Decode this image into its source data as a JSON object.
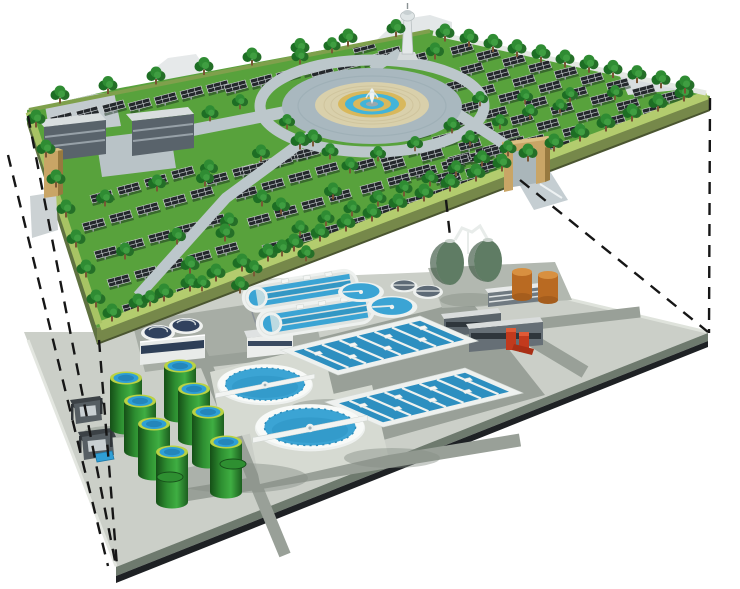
{
  "diagram": {
    "kind": "3d-cutaway-illustration",
    "upper_layer_name": "ground-level-solar-park",
    "lower_layer_name": "underground-wastewater-treatment-plant",
    "background": "#ffffff"
  },
  "palette": {
    "grass": "#58a23c",
    "grass_border": "#b3cc6e",
    "park_side_front": "#76884a",
    "park_side_left": "#5f7240",
    "park_back_path": "#e4e8e3",
    "plaza": "#a9b8bf",
    "cobble": "#d9d0ab",
    "fountain_tan": "#d8b85c",
    "fountain_blue": "#42b4d9",
    "road": "#bcc7cb",
    "building": "#59636b",
    "gate_tan": "#c9a566",
    "gate_tan_dark": "#97793f",
    "tree_dark": "#1d6e24",
    "tree_light": "#2f8c33",
    "trunk": "#7a5433",
    "panel": "#24282c",
    "panel_frame": "#d8dcde",
    "pavement": "#cbcfc8",
    "pavement_dark": "#99a098",
    "pavement_pad": "#d6dad2",
    "plant_edge_mid": "#6e7a6e",
    "plant_edge_dark": "#1e2124",
    "tank_green": "#2e8f31",
    "tank_rim": "#b9d244",
    "tank_water": "#2e9fd6",
    "clarifier_water": "#3ba4d4",
    "basin_water": "#2d8fc0",
    "unit_white": "#eef1ef",
    "digester_green": "#5f7c64",
    "orange_tank": "#b96a22",
    "orange_top": "#d89040",
    "red_equipment": "#c23a1d",
    "navy_cover": "#31425e",
    "slate_cover": "#5d6a76",
    "dash": "#161616"
  },
  "upper_layer": {
    "components": [
      "solar-panel-arrays",
      "shade-trees",
      "central-fountain-plaza",
      "observation-tower",
      "service-buildings",
      "entrance-gate-left",
      "entrance-gate-right",
      "ring-road",
      "perimeter-path"
    ]
  },
  "lower_layer": {
    "components": [
      "egg-shaped-digesters",
      "gas-storage-cylinders",
      "green-sludge-tanks",
      "primary-clarifiers",
      "secondary-clarifiers",
      "oxidation-ditches",
      "aeration-basins",
      "red-pump-station",
      "plant-buildings",
      "inlet-works"
    ]
  },
  "scene": {
    "panel_rows": [
      {
        "x": 50,
        "y": 112,
        "n": 3,
        "dx": 26,
        "dy": -6
      },
      {
        "x": 128,
        "y": 98,
        "n": 4,
        "dx": 26,
        "dy": -6
      },
      {
        "x": 224,
        "y": 80,
        "n": 4,
        "dx": 26,
        "dy": -6
      },
      {
        "x": 310,
        "y": 64,
        "n": 3,
        "dx": 26,
        "dy": -6
      },
      {
        "x": 90,
        "y": 190,
        "n": 4,
        "dx": 27,
        "dy": -8
      },
      {
        "x": 82,
        "y": 218,
        "n": 5,
        "dx": 27,
        "dy": -8
      },
      {
        "x": 94,
        "y": 246,
        "n": 5,
        "dx": 27,
        "dy": -8
      },
      {
        "x": 107,
        "y": 274,
        "n": 5,
        "dx": 27,
        "dy": -8
      },
      {
        "x": 122,
        "y": 300,
        "n": 4,
        "dx": 27,
        "dy": -8
      },
      {
        "x": 142,
        "y": 322,
        "n": 3,
        "dx": 27,
        "dy": -8
      },
      {
        "x": 205,
        "y": 172,
        "n": 4,
        "dx": 27,
        "dy": -8
      },
      {
        "x": 242,
        "y": 162,
        "n": 3,
        "dx": 27,
        "dy": -8
      },
      {
        "x": 234,
        "y": 186,
        "n": 4,
        "dx": 27,
        "dy": -8
      },
      {
        "x": 247,
        "y": 213,
        "n": 4,
        "dx": 27,
        "dy": -8
      },
      {
        "x": 262,
        "y": 240,
        "n": 4,
        "dx": 27,
        "dy": -8
      },
      {
        "x": 277,
        "y": 266,
        "n": 3,
        "dx": 27,
        "dy": -8
      },
      {
        "x": 293,
        "y": 291,
        "n": 2,
        "dx": 27,
        "dy": -8
      },
      {
        "x": 352,
        "y": 158,
        "n": 4,
        "dx": 27,
        "dy": -8
      },
      {
        "x": 360,
        "y": 181,
        "n": 5,
        "dx": 27,
        "dy": -8
      },
      {
        "x": 374,
        "y": 203,
        "n": 4,
        "dx": 27,
        "dy": -8
      },
      {
        "x": 335,
        "y": 228,
        "n": 4,
        "dx": 27,
        "dy": -8
      },
      {
        "x": 448,
        "y": 152,
        "n": 3,
        "dx": 27,
        "dy": -8
      },
      {
        "x": 438,
        "y": 172,
        "n": 2,
        "dx": 27,
        "dy": -8
      },
      {
        "x": 460,
        "y": 62,
        "n": 9,
        "dx": 26,
        "dy": 6
      },
      {
        "x": 446,
        "y": 78,
        "n": 9,
        "dx": 26,
        "dy": 6
      },
      {
        "x": 432,
        "y": 94,
        "n": 9,
        "dx": 26,
        "dy": 6
      },
      {
        "x": 418,
        "y": 110,
        "n": 9,
        "dx": 26,
        "dy": 6
      },
      {
        "x": 406,
        "y": 126,
        "n": 8,
        "dx": 26,
        "dy": 6
      },
      {
        "x": 394,
        "y": 142,
        "n": 7,
        "dx": 26,
        "dy": 6
      },
      {
        "x": 382,
        "y": 158,
        "n": 5,
        "dx": 26,
        "dy": 6
      },
      {
        "x": 450,
        "y": 42,
        "n": 9,
        "dx": 26,
        "dy": 6
      },
      {
        "x": 352,
        "y": 40,
        "n": 3,
        "dx": 26,
        "dy": 6
      }
    ],
    "tree_rows": [
      {
        "x": 112,
        "y": 320,
        "n": 23,
        "dx": 26,
        "dy": -10,
        "s": 1
      },
      {
        "x": 300,
        "y": 235,
        "n": 9,
        "dx": 26,
        "dy": -10,
        "s": 0.9
      },
      {
        "x": 36,
        "y": 126,
        "n": 7,
        "dx": 10,
        "dy": 30,
        "s": 1
      },
      {
        "x": 445,
        "y": 40,
        "n": 11,
        "dx": 24,
        "dy": 5.2,
        "s": 1
      },
      {
        "x": 60,
        "y": 102,
        "n": 8,
        "dx": 48,
        "dy": -9.5,
        "s": 1
      },
      {
        "x": 105,
        "y": 205,
        "n": 5,
        "dx": 52,
        "dy": -15,
        "s": 0.95
      },
      {
        "x": 125,
        "y": 258,
        "n": 5,
        "dx": 52,
        "dy": -15,
        "s": 0.95
      },
      {
        "x": 150,
        "y": 305,
        "n": 4,
        "dx": 52,
        "dy": -15,
        "s": 0.9
      },
      {
        "x": 480,
        "y": 105,
        "n": 4,
        "dx": 45,
        "dy": -2,
        "s": 0.85
      }
    ],
    "trees": [
      [
        300,
        148,
        1
      ],
      [
        330,
        158,
        0.9
      ],
      [
        287,
        128,
        0.85
      ],
      [
        300,
        63,
        0.9
      ],
      [
        332,
        52,
        0.9
      ],
      [
        435,
        58,
        0.95
      ],
      [
        452,
        132,
        0.9
      ],
      [
        470,
        145,
        0.9
      ],
      [
        415,
        150,
        0.85
      ],
      [
        205,
        185,
        0.95
      ],
      [
        262,
        205,
        0.95
      ],
      [
        225,
        240,
        1
      ],
      [
        282,
        255,
        0.95
      ],
      [
        190,
        272,
        1
      ],
      [
        240,
        292,
        0.95
      ],
      [
        378,
        160,
        0.85
      ],
      [
        350,
        172,
        0.9
      ],
      [
        500,
        128,
        0.85
      ],
      [
        530,
        118,
        0.85
      ],
      [
        560,
        112,
        0.8
      ],
      [
        210,
        120,
        0.9
      ],
      [
        240,
        108,
        0.85
      ]
    ],
    "green_tanks": [
      [
        180,
        366
      ],
      [
        126,
        378
      ],
      [
        194,
        389
      ],
      [
        140,
        401
      ],
      [
        208,
        412
      ],
      [
        154,
        424
      ],
      [
        226,
        442
      ],
      [
        172,
        452
      ]
    ],
    "tank_pads": [
      [
        170,
        477
      ],
      [
        233,
        464
      ]
    ],
    "dashed_lines": [
      [
        28,
        116,
        116,
        566
      ],
      [
        8,
        155,
        108,
        566
      ],
      [
        99,
        340,
        117,
        566
      ],
      [
        710,
        98,
        709,
        333
      ],
      [
        520,
        180,
        708,
        332
      ],
      [
        446,
        200,
        450,
        236
      ]
    ]
  }
}
